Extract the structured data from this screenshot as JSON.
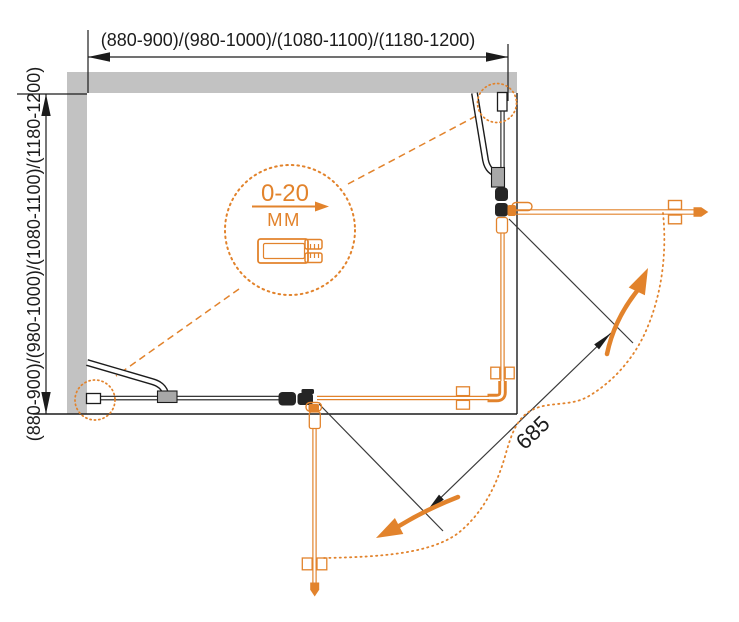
{
  "diagram": {
    "type": "shower-enclosure-installation-drawing",
    "colors": {
      "accent_orange": "#E2832C",
      "wall_gray": "#C2C2C2",
      "line_black": "#1C1C1C",
      "mount_gray": "#A8A8A8"
    },
    "dimensions": {
      "width_label": "(880-900)/(980-1000)/(1080-1100)/(1180-1200)",
      "depth_label": "(880-900)/(980-1000)/(1080-1100)/(1180-1200)",
      "entry_label": "685"
    },
    "detail_callout": {
      "range": "0-20",
      "unit": "ММ"
    }
  }
}
